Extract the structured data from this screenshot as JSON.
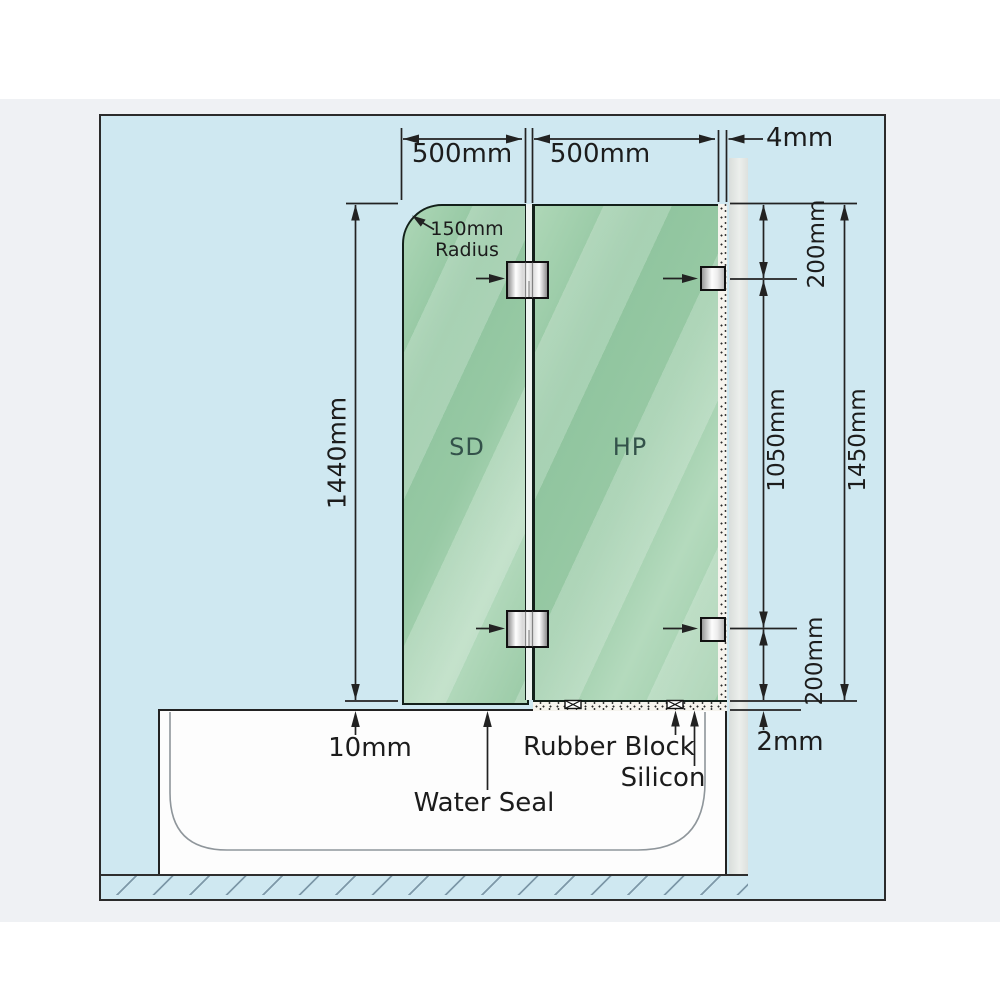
{
  "diagram": {
    "type": "shower-screen-installation-spec",
    "panels": {
      "left_label": "SD",
      "right_label": "HP"
    },
    "dims": {
      "panel_width_left": "500mm",
      "panel_width_right": "500mm",
      "wall_gap": "4mm",
      "corner_radius_value": "150mm",
      "corner_radius_word": "Radius",
      "panel_height_left": "1440mm",
      "bracket_top_offset": "200mm",
      "bracket_span": "1050mm",
      "overall_height": "1450mm",
      "bracket_bottom_offset": "200mm",
      "bottom_gap": "10mm",
      "silicon_bed": "2mm"
    },
    "callouts": {
      "water_seal": "Water Seal",
      "rubber_block": "Rubber Block",
      "silicon": "Silicon"
    },
    "colors": {
      "canvas_blue": "#cfe8f1",
      "glass_green": "#9ccaa7",
      "wall_gray": "#e2e6e4",
      "outer_band": "#eff1f4",
      "tub_white": "#fdfdfd",
      "line": "#222222"
    }
  }
}
